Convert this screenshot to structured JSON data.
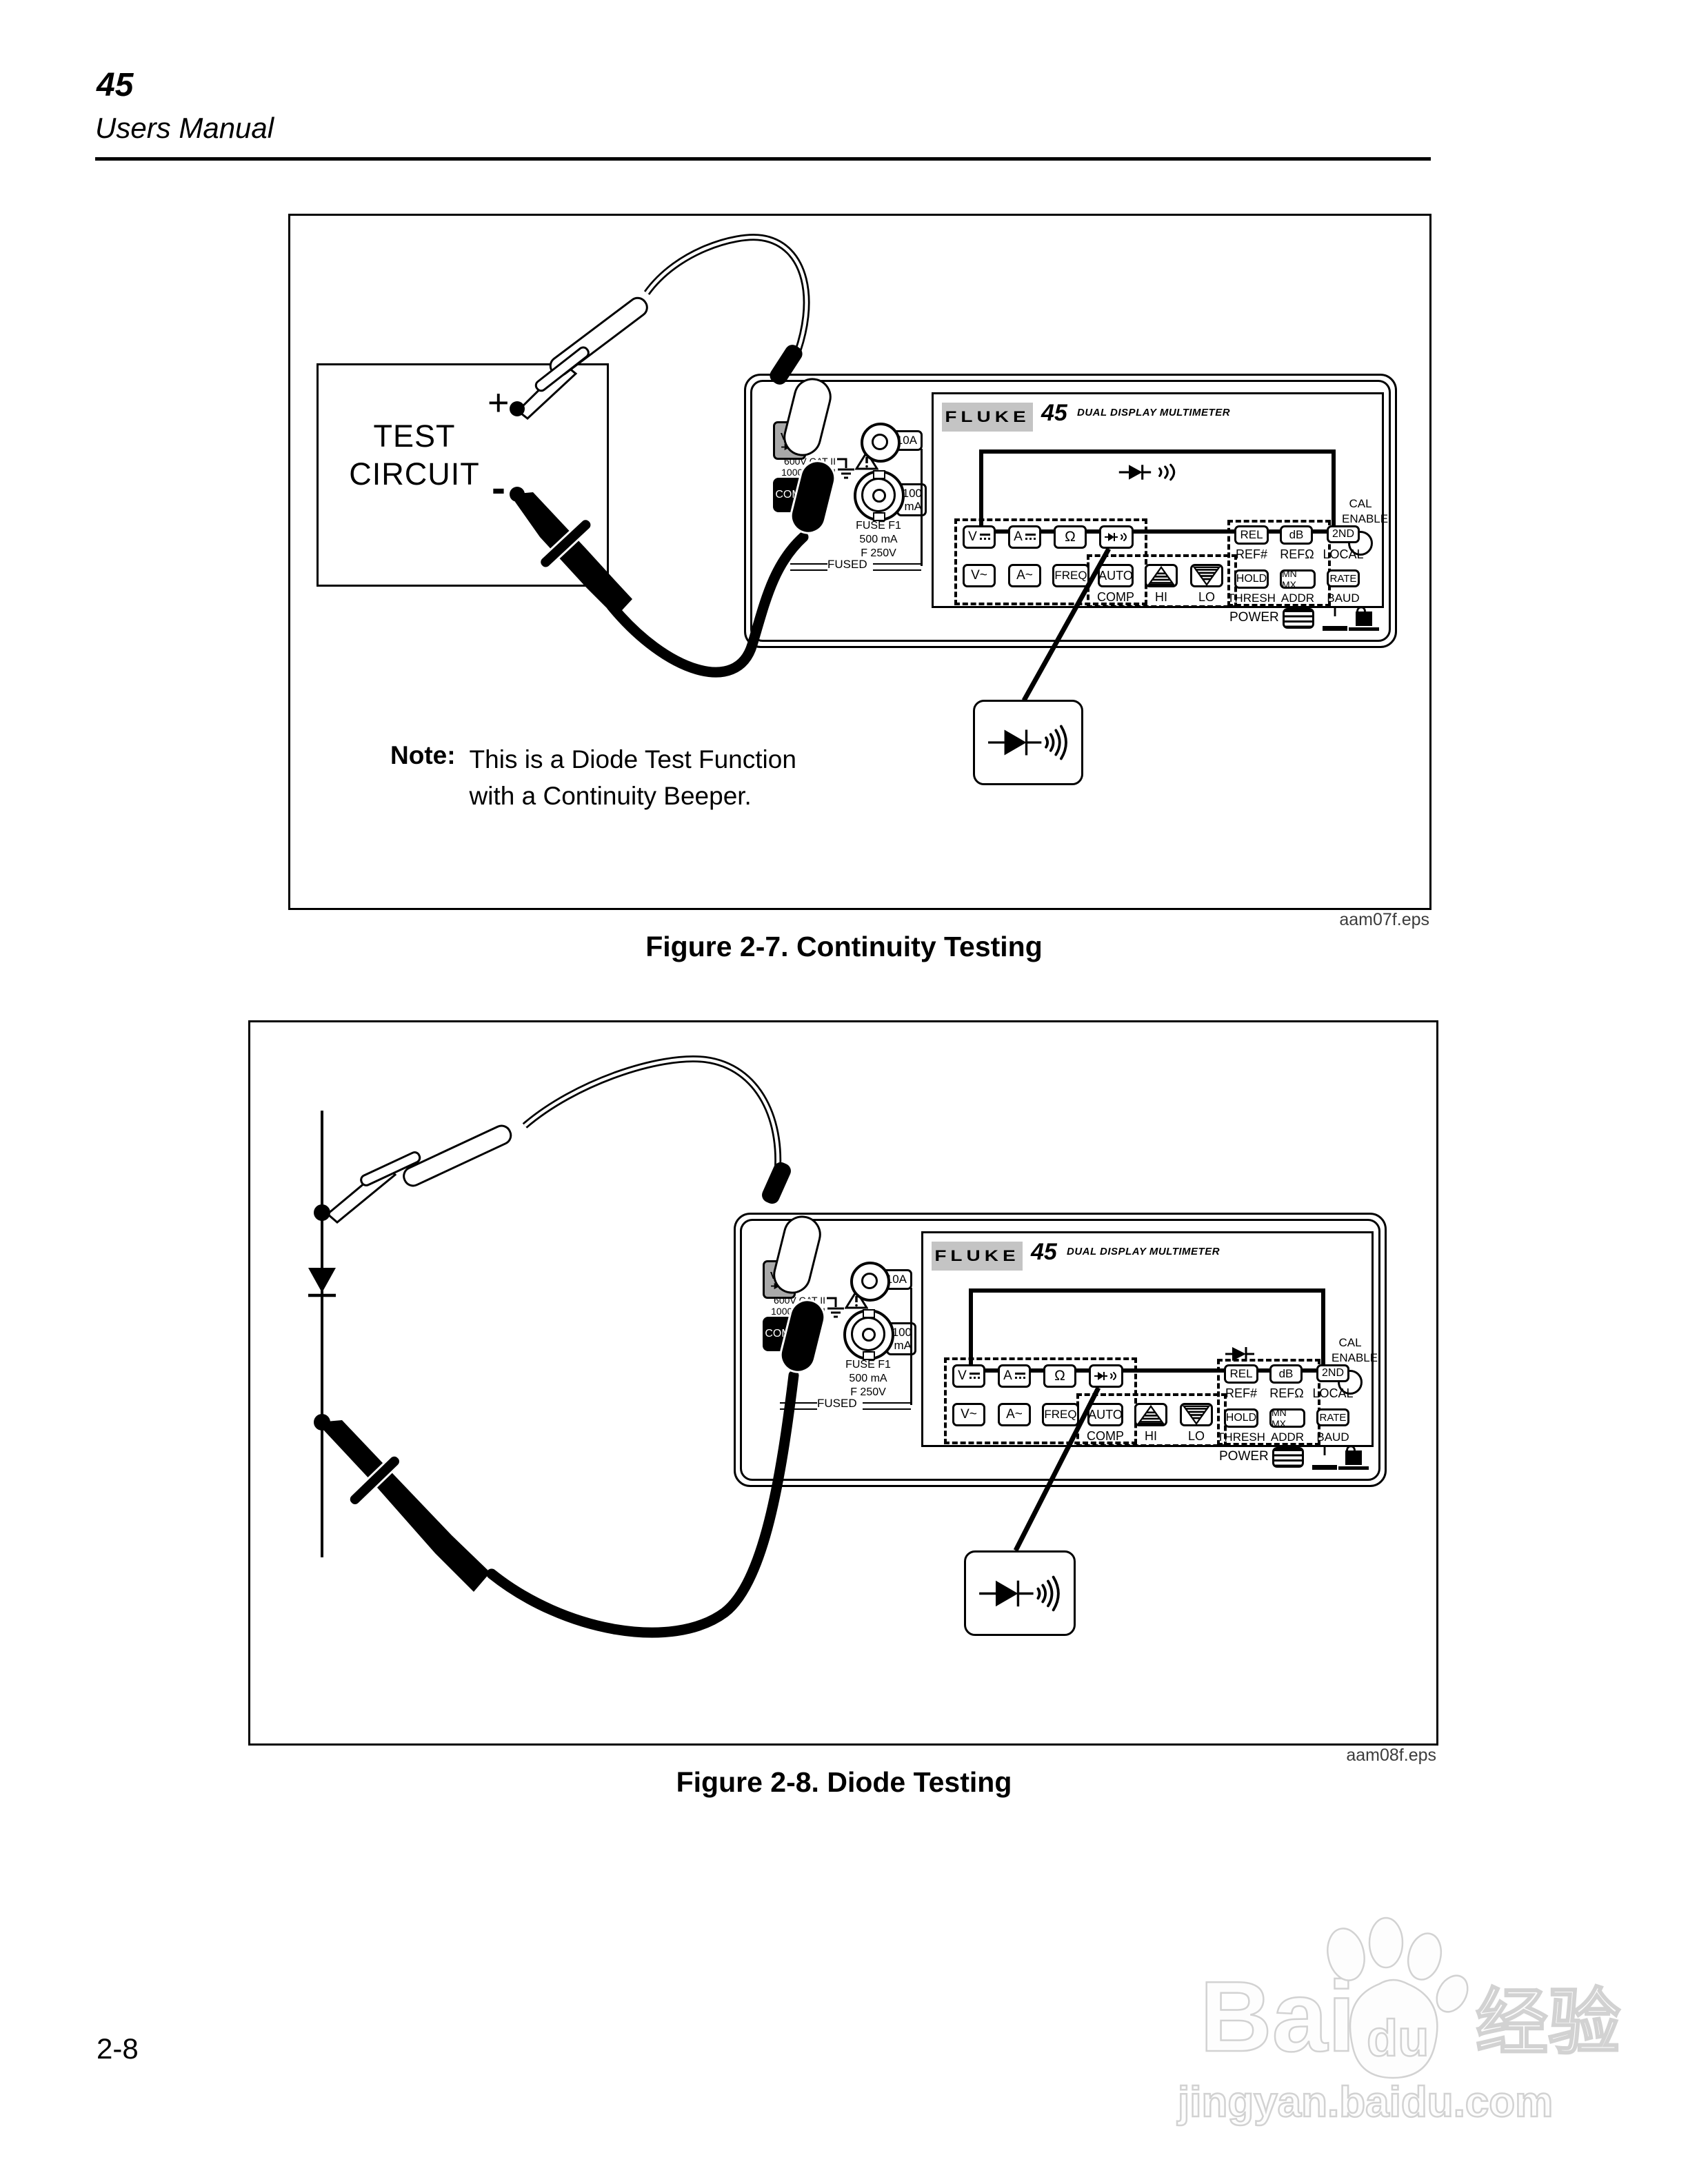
{
  "header": {
    "model": "45",
    "subtitle": "Users Manual"
  },
  "page_number": "2-8",
  "figure1": {
    "caption": "Figure 2-7. Continuity Testing",
    "eps_label": "aam07f.eps",
    "note_label": "Note:",
    "note_line1": "This is a Diode Test Function",
    "note_line2": "with a Continuity Beeper.",
    "test_circuit_line1": "TEST",
    "test_circuit_line2": "CIRCUIT",
    "plus_label": "+",
    "minus_label": "-"
  },
  "figure2": {
    "caption": "Figure 2-8. Diode Testing",
    "eps_label": "aam08f.eps"
  },
  "meter": {
    "brand": "FLUKE",
    "model": "45",
    "type_label": "DUAL DISPLAY MULTIMETER",
    "cal_line1": "CAL",
    "cal_line2": "ENABLE",
    "power_label": "POWER",
    "power_on": "I",
    "power_off": "O",
    "jacks": {
      "vohm": "V Ω",
      "amp10": "10A",
      "com": "COM",
      "ma100_line1": "100",
      "ma100_line2": "mA",
      "cat_line1": "600V CAT II",
      "cat_line2": "1000V CAT I",
      "fuse_line1": "FUSE F1",
      "fuse_line2": "500 mA",
      "fuse_line3": "F 250V",
      "fused": "FUSED"
    },
    "buttons": {
      "vdc": "V",
      "adc": "A",
      "ohms": "Ω",
      "vac": "V~",
      "aac": "A~",
      "freq": "FREQ",
      "auto": "AUTO",
      "comp": "COMP",
      "hi": "HI",
      "lo": "LO",
      "rel": "REL",
      "ref_num": "REF#",
      "db": "dB",
      "ref_ohm": "REFΩ",
      "second": "2ND",
      "local": "LOCAL",
      "hold": "HOLD",
      "thresh": "THRESH",
      "mnmx": "MN MX",
      "addr": "ADDR",
      "rate": "RATE",
      "baud": "BAUD"
    }
  },
  "watermark": {
    "brand": "Bai",
    "paw_text": "du",
    "suffix": "经验",
    "url": "jingyan.baidu.com"
  }
}
